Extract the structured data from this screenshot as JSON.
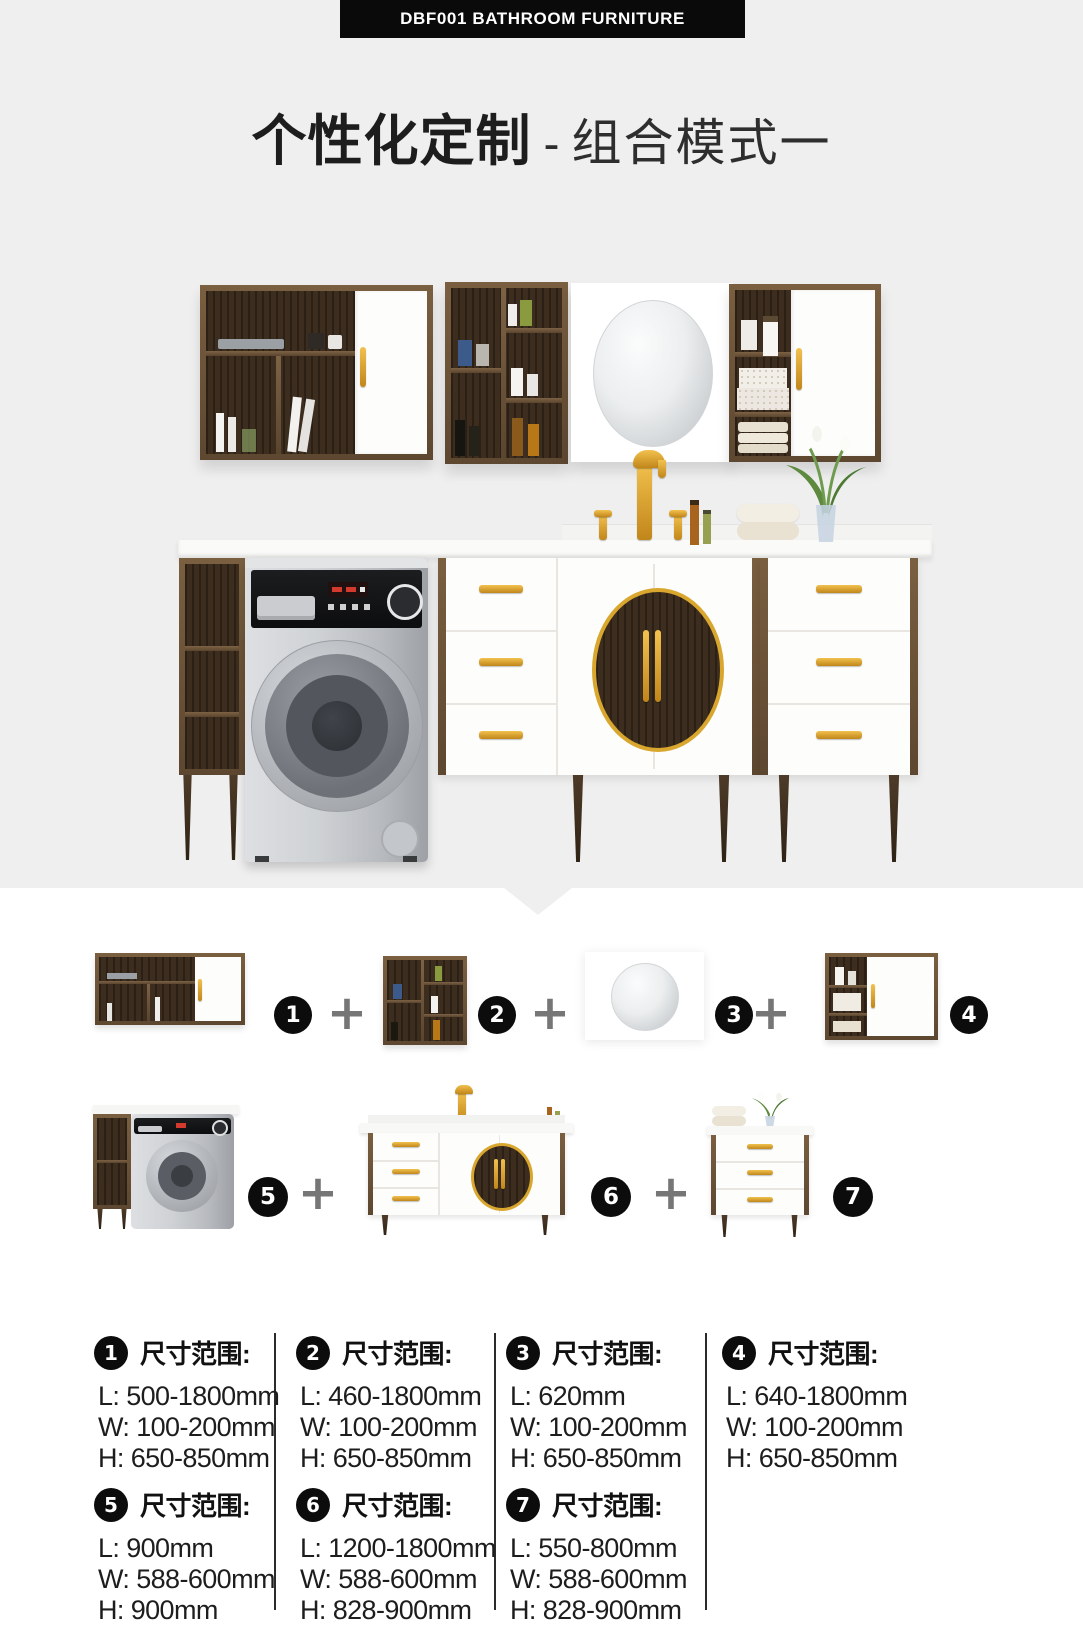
{
  "banner": {
    "text": "DBF001 BATHROOM FURNITURE"
  },
  "title": {
    "bold": "个性化定制",
    "separator": "-",
    "light": "组合模式一"
  },
  "icons": {
    "plus": "+"
  },
  "colors": {
    "background_gray": "#efefef",
    "panel_white": "#ffffff",
    "badge_black": "#0c0c0c",
    "gold_accent": "#d49a2a",
    "wood_brown": "#55412c",
    "plus_gray": "#767676"
  },
  "components": {
    "row1": {
      "badges": [
        "1",
        "2",
        "3",
        "4"
      ]
    },
    "row2": {
      "badges": [
        "5",
        "6",
        "7"
      ]
    }
  },
  "specs": {
    "heading_label": "尺寸范围:",
    "items": [
      {
        "num": "1",
        "l": "L: 500-1800mm",
        "w": "W: 100-200mm",
        "h": "H: 650-850mm"
      },
      {
        "num": "2",
        "l": "L: 460-1800mm",
        "w": "W: 100-200mm",
        "h": "H: 650-850mm"
      },
      {
        "num": "3",
        "l": "L: 620mm",
        "w": "W: 100-200mm",
        "h": "H: 650-850mm"
      },
      {
        "num": "4",
        "l": "L: 640-1800mm",
        "w": "W: 100-200mm",
        "h": "H: 650-850mm"
      },
      {
        "num": "5",
        "l": "L: 900mm",
        "w": "W: 588-600mm",
        "h": "H: 900mm"
      },
      {
        "num": "6",
        "l": "L: 1200-1800mm",
        "w": "W: 588-600mm",
        "h": "H: 828-900mm"
      },
      {
        "num": "7",
        "l": "L: 550-800mm",
        "w": "W: 588-600mm",
        "h": "H: 828-900mm"
      }
    ]
  }
}
